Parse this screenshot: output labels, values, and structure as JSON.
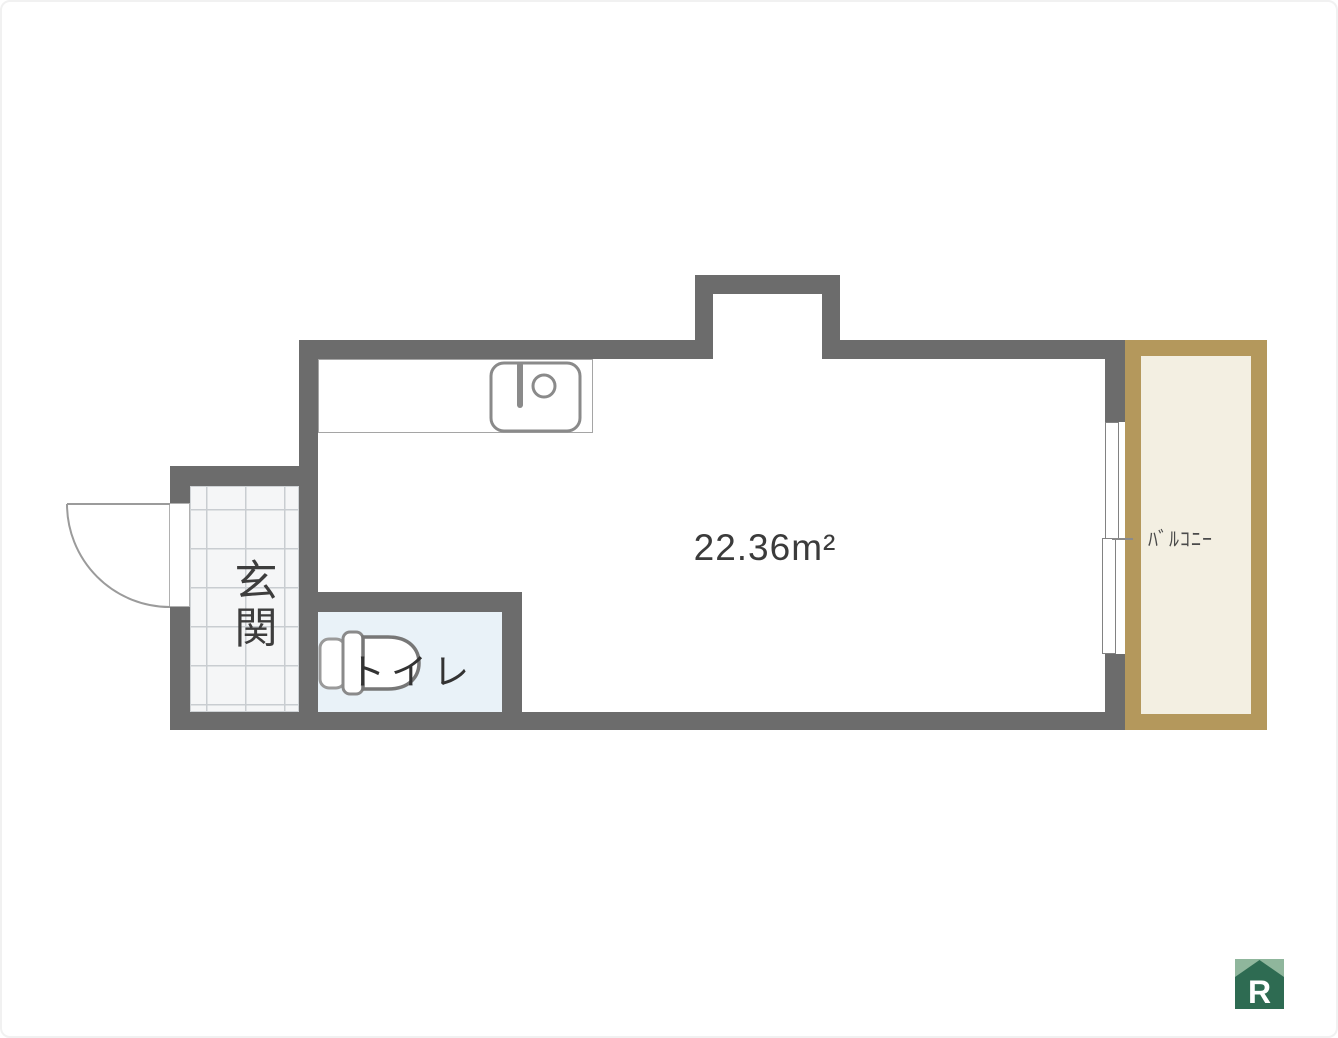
{
  "floor_plan": {
    "main_room": {
      "area_label": "22.36m²"
    },
    "entrance": {
      "label": "玄関"
    },
    "toilet": {
      "label": "トイレ"
    },
    "balcony": {
      "label": "ﾊﾞﾙｺﾆｰ"
    },
    "logo": {
      "letter": "R"
    },
    "icons": [
      "kitchen-sink-icon",
      "toilet-bowl-icon",
      "door-swing-icon",
      "sliding-window-icon",
      "house-logo-icon"
    ],
    "colors": {
      "wall_gray": "#6c6c6c",
      "balcony_border_tan": "#b4985c",
      "balcony_floor_cream": "#f3efe2",
      "toilet_floor_blue": "#e9f2f8",
      "entrance_tile_line": "#c9cdd1",
      "logo_green_dark": "#2e6b52",
      "logo_green_light": "#8fb69c"
    }
  }
}
